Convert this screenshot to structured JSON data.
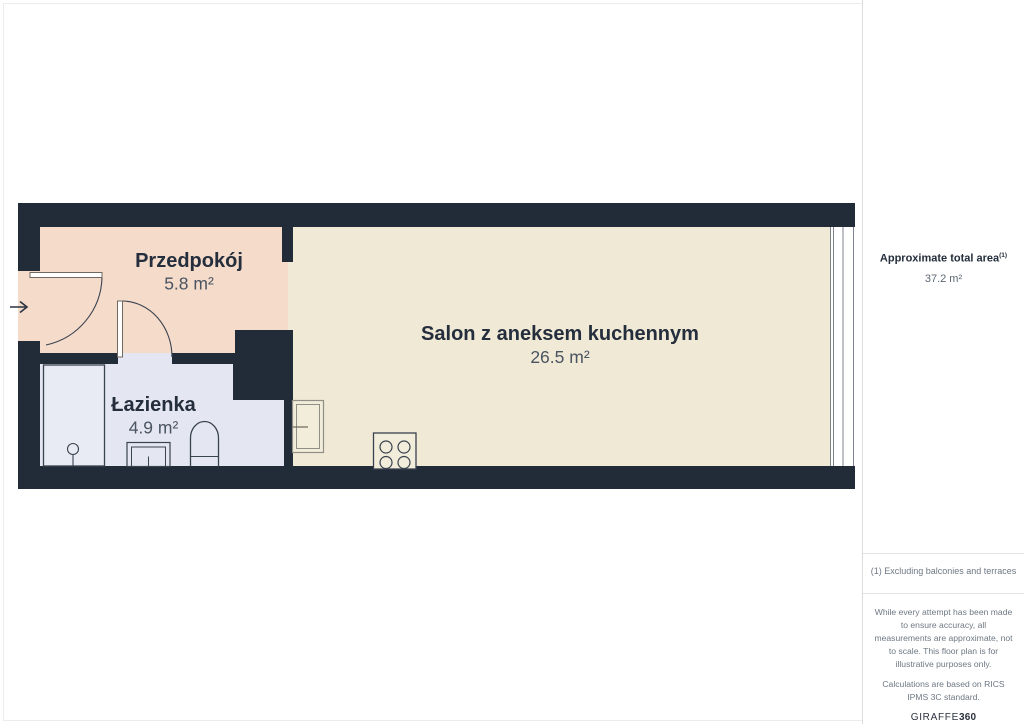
{
  "floor_plan": {
    "rooms": [
      {
        "name": "Przedpokój",
        "area": "5.8 m²"
      },
      {
        "name": "Salon z aneksem kuchennym",
        "area": "26.5 m²"
      },
      {
        "name": "Łazienka",
        "area": "4.9 m²"
      }
    ],
    "colors": {
      "wall": "#222b38",
      "hallway": "#f5dbca",
      "living_room": "#f0e9d6",
      "bathroom": "#e4e7f1"
    }
  },
  "sidebar": {
    "total_area_label": "Approximate total area",
    "total_area_superscript": "(1)",
    "total_area_value": "37.2 m²",
    "footnote": "(1) Excluding balconies and terraces",
    "disclaimer_1": "While every attempt has been made to ensure accuracy, all measurements are approximate, not to scale. This floor plan is for illustrative purposes only.",
    "disclaimer_2": "Calculations are based on RICS IPMS 3C standard.",
    "brand_name": "GIRAFFE",
    "brand_number": "360"
  }
}
